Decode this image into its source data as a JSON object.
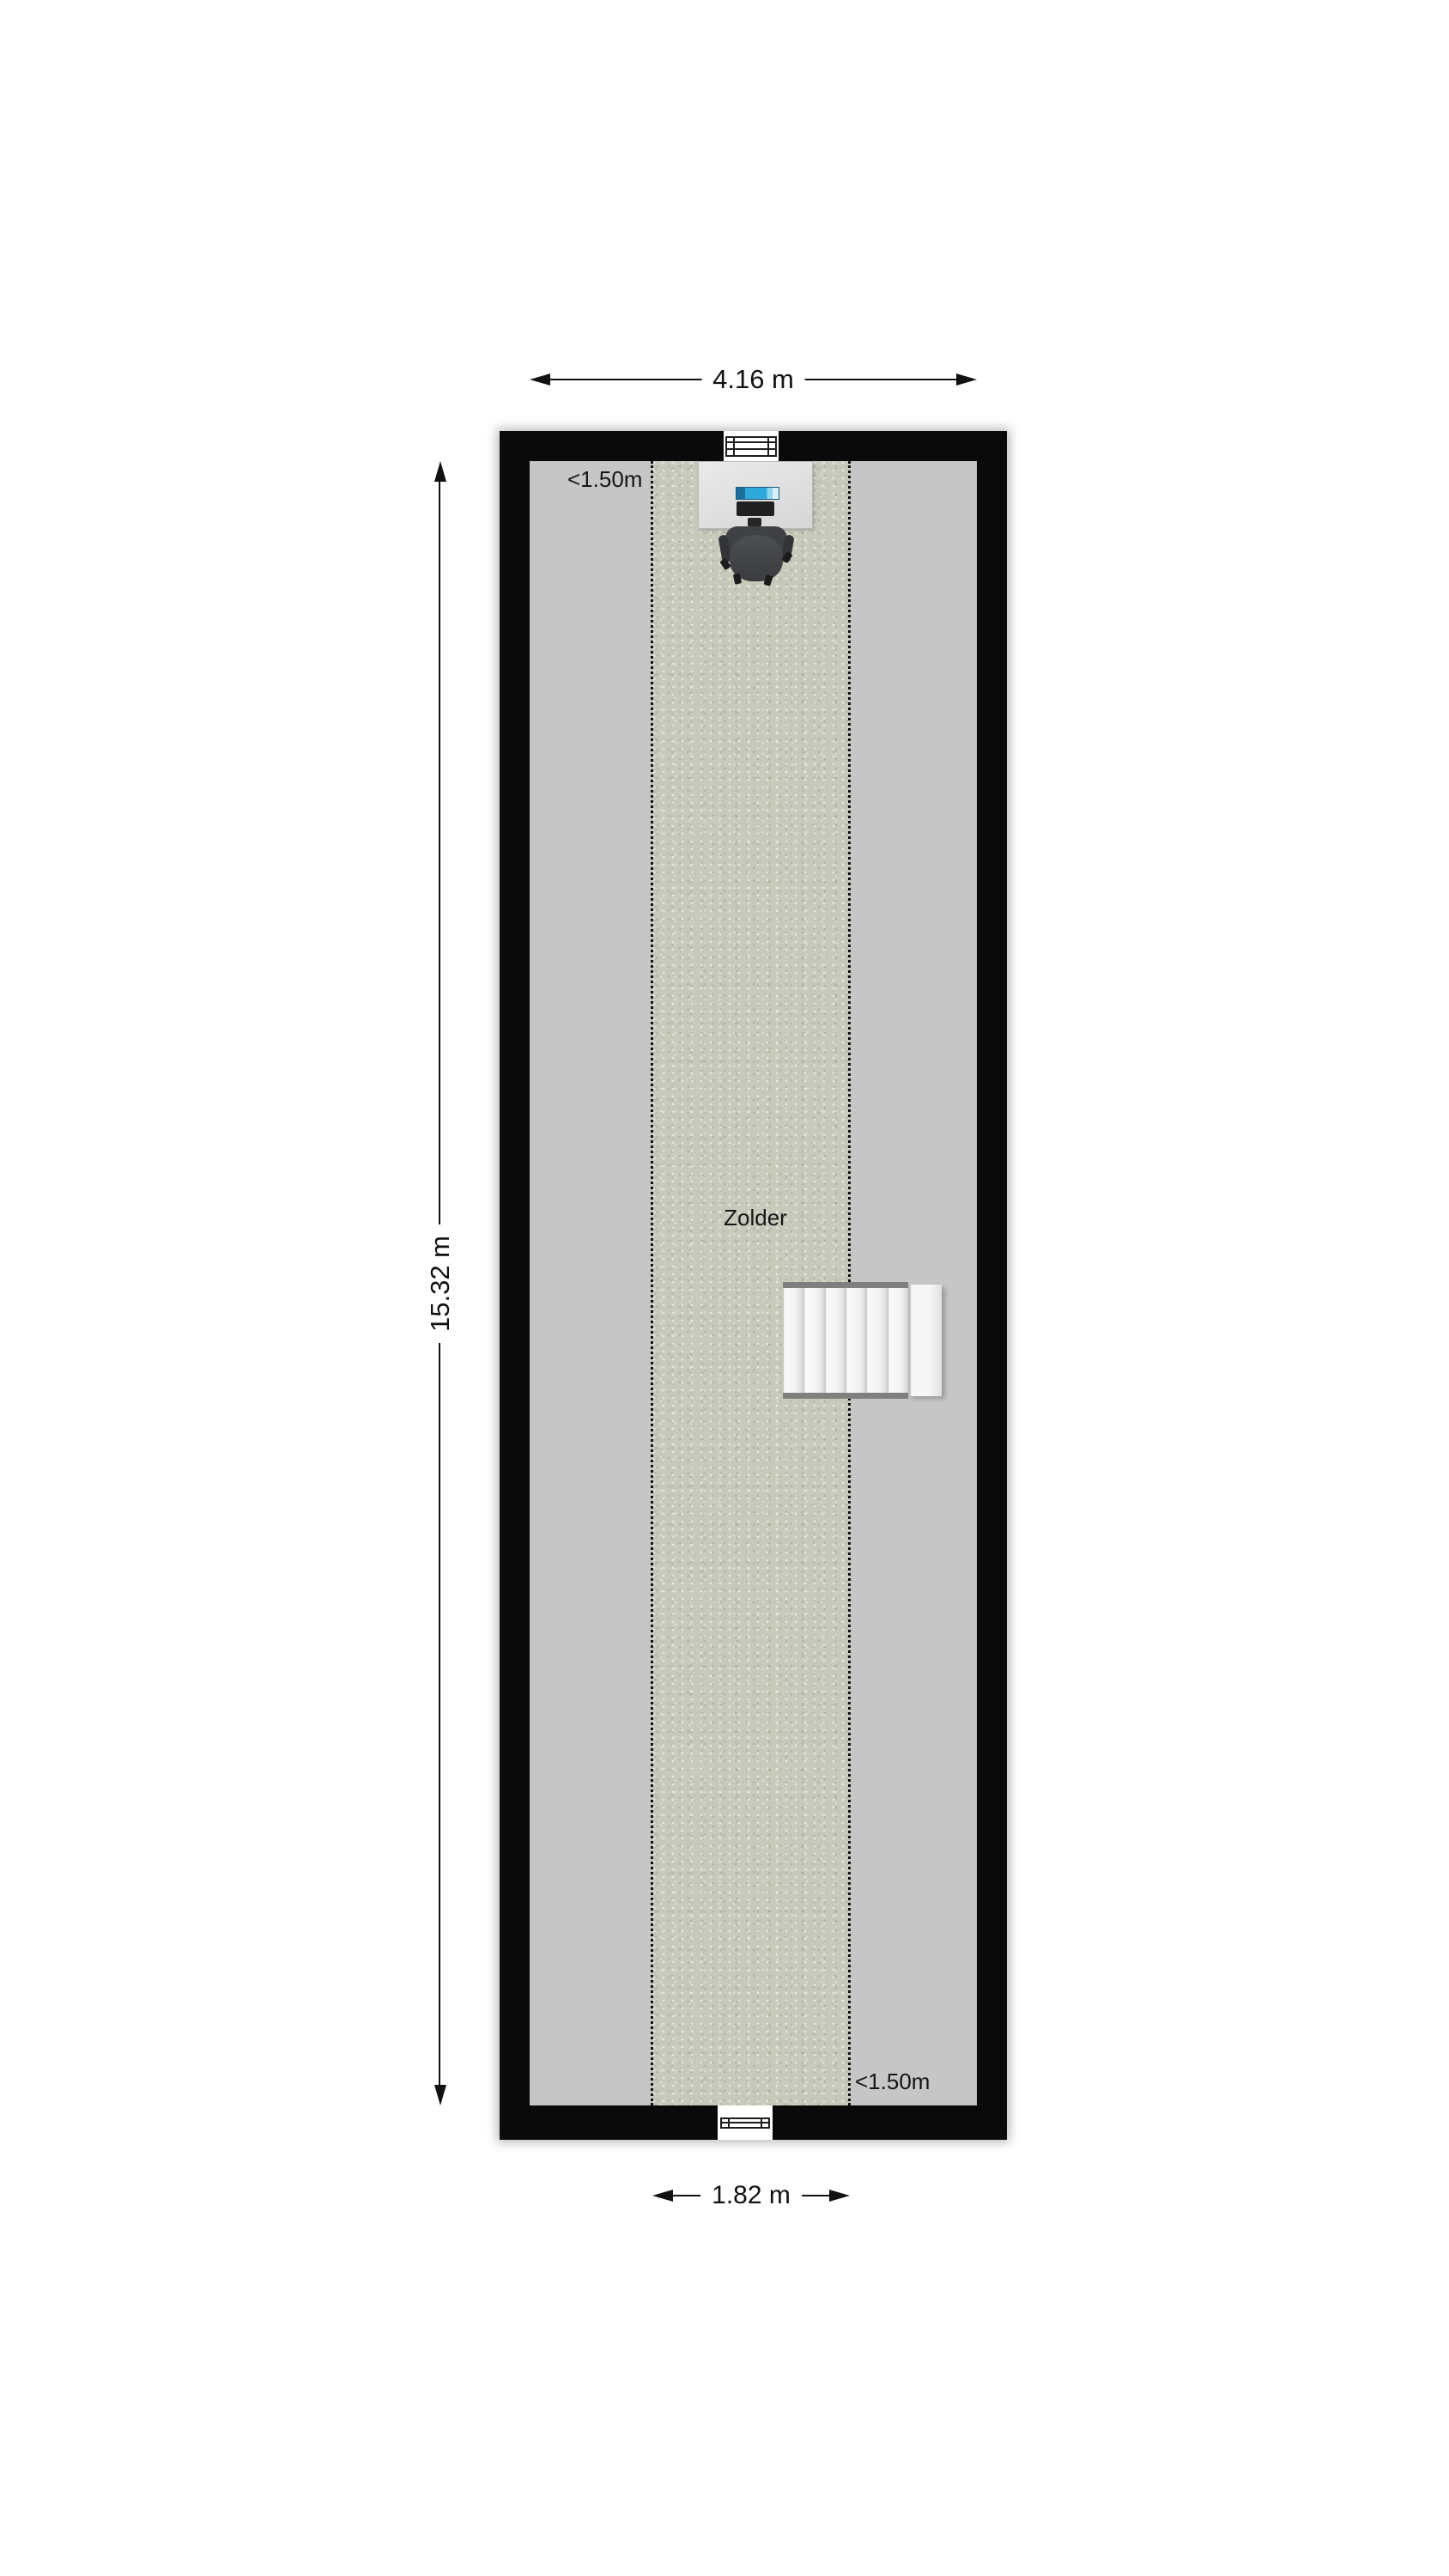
{
  "room": {
    "label": "Zolder"
  },
  "dimensions": {
    "width_top": "4.16 m",
    "height_left": "15.32 m",
    "width_bottom": "1.82 m"
  },
  "height_markers": {
    "top_left": "<1.50m",
    "bottom_right": "<1.50m"
  },
  "colors": {
    "wall": "#0a0a0a",
    "floor": "#c6c6c6",
    "carpet": "#c8c9bb",
    "dash": "#111111",
    "stairs": "#f4f4f4",
    "stair_stringer": "#7f7f7f",
    "monitor": "#2fa8dc",
    "keyboard": "#212121",
    "casters": "#1c1c1c",
    "dimension": "#111111",
    "text": "#161616"
  }
}
